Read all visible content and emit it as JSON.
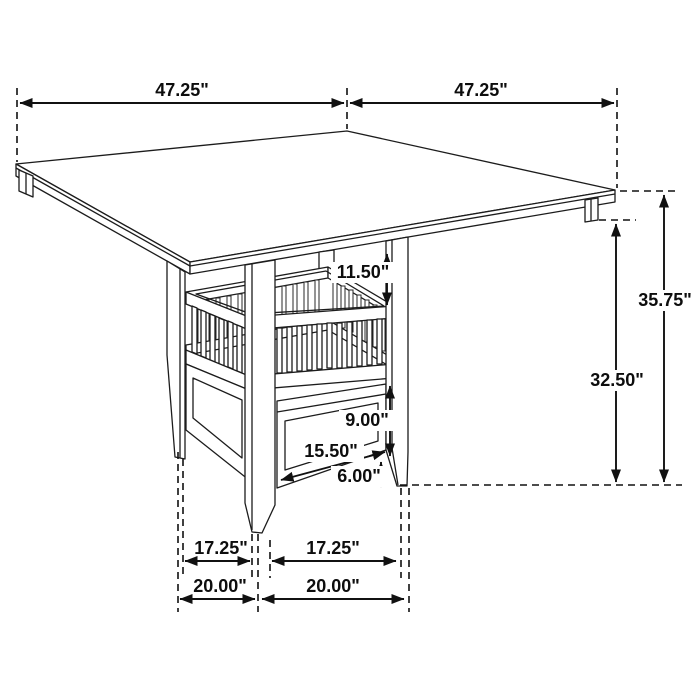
{
  "diagram": {
    "type": "furniture-dimension-drawing",
    "subject": "Counter-height square dining table with slatted storage-shelf pedestal and drawer",
    "unit": "inches",
    "background_color": "#ffffff",
    "line_color": "#1c1c1c",
    "dims": {
      "top_left": "47.25\"",
      "top_right": "47.25\"",
      "overall_height": "35.75\"",
      "underside_clearance": "32.50\"",
      "top_to_shelf": "11.50\"",
      "storage_height": "9.00\"",
      "storage_width": "15.50\"",
      "foot_clearance": "6.00\"",
      "legs_inner_left": "17.25\"",
      "legs_inner_right": "17.25\"",
      "legs_outer_left": "20.00\"",
      "legs_outer_right": "20.00\""
    }
  }
}
